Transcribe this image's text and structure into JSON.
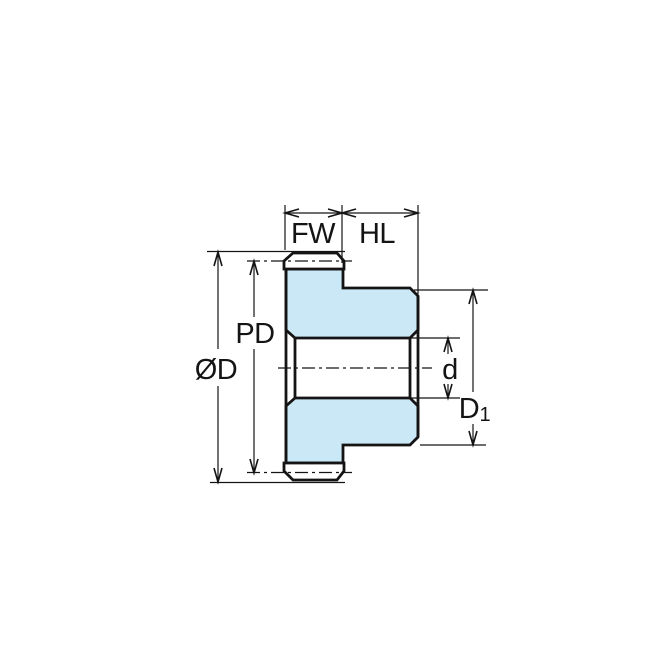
{
  "diagram": {
    "labels": {
      "fw": "FW",
      "hl": "HL",
      "pd": "PD",
      "od": "ØD",
      "d": "d",
      "d1_base": "D",
      "d1_sub": "1"
    },
    "colors": {
      "part_fill": "#CBE8F7",
      "line": "#141414",
      "background": "#FFFFFF"
    }
  }
}
